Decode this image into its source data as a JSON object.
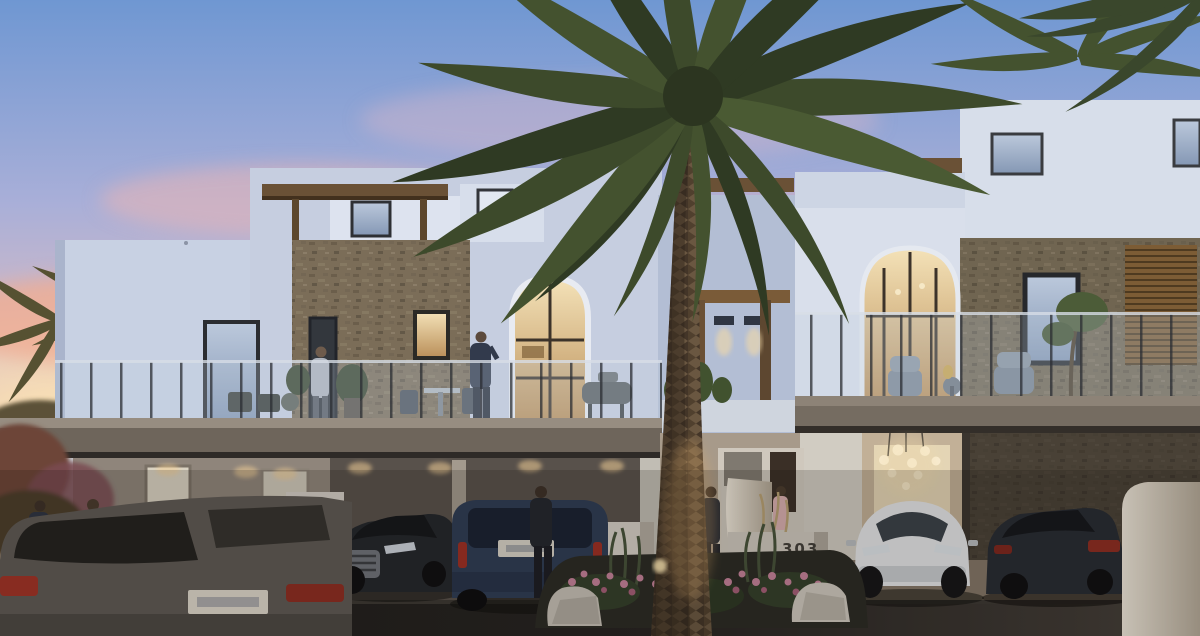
{
  "scene": {
    "type": "exterior-architectural-rendering",
    "time_of_day": "dusk",
    "description": "Row of modern two-storey white townhouses with stone feature walls and rooftop terraces at sunset; a tall date palm rises from a flowering median bed between gate walls numbered 302 and 303; residents relax on the terraces while cars are parked in the driveways and along the street.",
    "gate_walls": [
      {
        "number": "302"
      },
      {
        "number": "303"
      }
    ],
    "vehicles": [
      "charcoal suv (foreground)",
      "light-blue sedan",
      "silver sedan",
      "black sedan",
      "dark-blue suv",
      "white crossover",
      "dark sedan"
    ],
    "people_count": 6
  },
  "colors": {
    "sky_top": "#6f97d2",
    "sky_mid": "#c9bfd6",
    "sunset_pink": "#eeb2a6",
    "sunset_gold": "#f6d7a6",
    "facade_white": "#dde3ee",
    "facade_shadow": "#b7c1d6",
    "stone": "#8d7e66",
    "wood": "#6b5136",
    "terrace_slab": "#6e655b",
    "glass_rail": "#b9c9da",
    "palm_green": "#3d4a2b",
    "palm_trunk": "#6a5741",
    "warm_light": "#f2d9a8",
    "flower_pink": "#c5829a",
    "road": "#232120"
  }
}
